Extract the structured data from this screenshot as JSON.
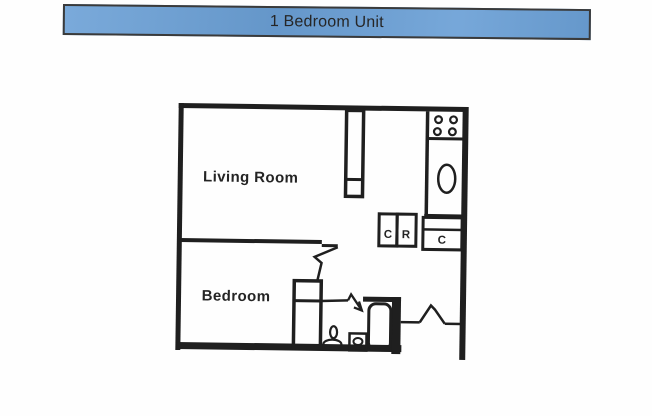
{
  "banner": {
    "title": "1 Bedroom Unit",
    "background_color": "#6BA0D6",
    "border_color": "#3a3a3a"
  },
  "plan": {
    "rooms": {
      "living_room": "Living Room",
      "bedroom": "Bedroom"
    },
    "closets": {
      "left": "C",
      "refrigerator": "R",
      "right": "C"
    },
    "fixtures": [
      "stove-burners",
      "kitchen-sink",
      "closet",
      "toilet",
      "bathroom-sink",
      "bathtub",
      "door-swings"
    ],
    "line_color": "#1f1f1f"
  }
}
